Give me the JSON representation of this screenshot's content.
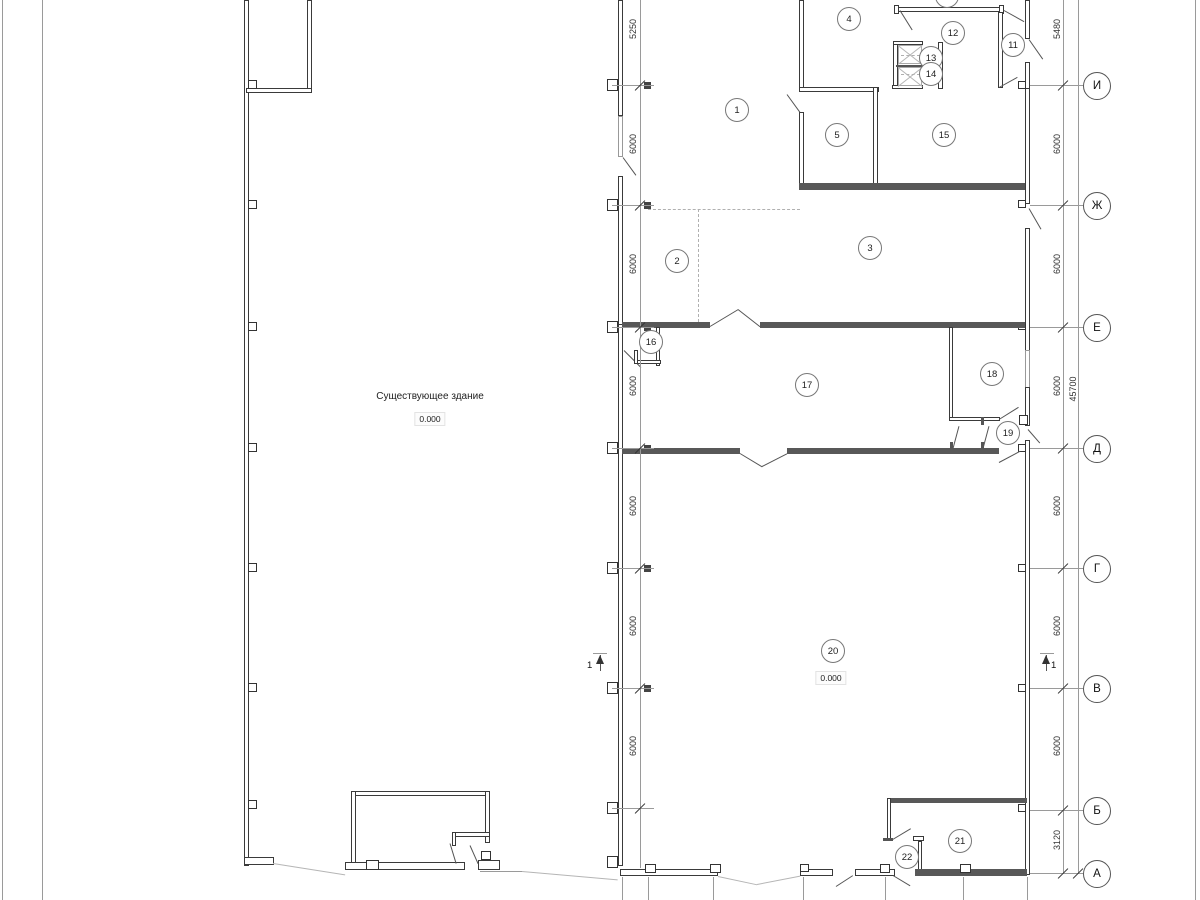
{
  "drawing": {
    "building_label": "Существующее здание",
    "elevation_left": "0.000",
    "elevation_right": "0.000",
    "section_mark": "1"
  },
  "rooms": [
    {
      "label": "1"
    },
    {
      "label": "2"
    },
    {
      "label": "3"
    },
    {
      "label": "4"
    },
    {
      "label": "5"
    },
    {
      "label": "11"
    },
    {
      "label": "12"
    },
    {
      "label": "13"
    },
    {
      "label": "14"
    },
    {
      "label": "15"
    },
    {
      "label": "16"
    },
    {
      "label": "17"
    },
    {
      "label": "18"
    },
    {
      "label": "19"
    },
    {
      "label": "20"
    },
    {
      "label": "21"
    },
    {
      "label": "22"
    }
  ],
  "axes": [
    {
      "label": "И"
    },
    {
      "label": "Ж"
    },
    {
      "label": "Е"
    },
    {
      "label": "Д"
    },
    {
      "label": "Г"
    },
    {
      "label": "В"
    },
    {
      "label": "Б"
    },
    {
      "label": "А"
    }
  ],
  "dims_left": [
    "5250",
    "6000",
    "6000",
    "6000",
    "6000",
    "6000",
    "6000"
  ],
  "dims_right": [
    "5480",
    "6000",
    "6000",
    "6000",
    "6000",
    "6000",
    "6000",
    "3120"
  ],
  "dim_total": "45700"
}
